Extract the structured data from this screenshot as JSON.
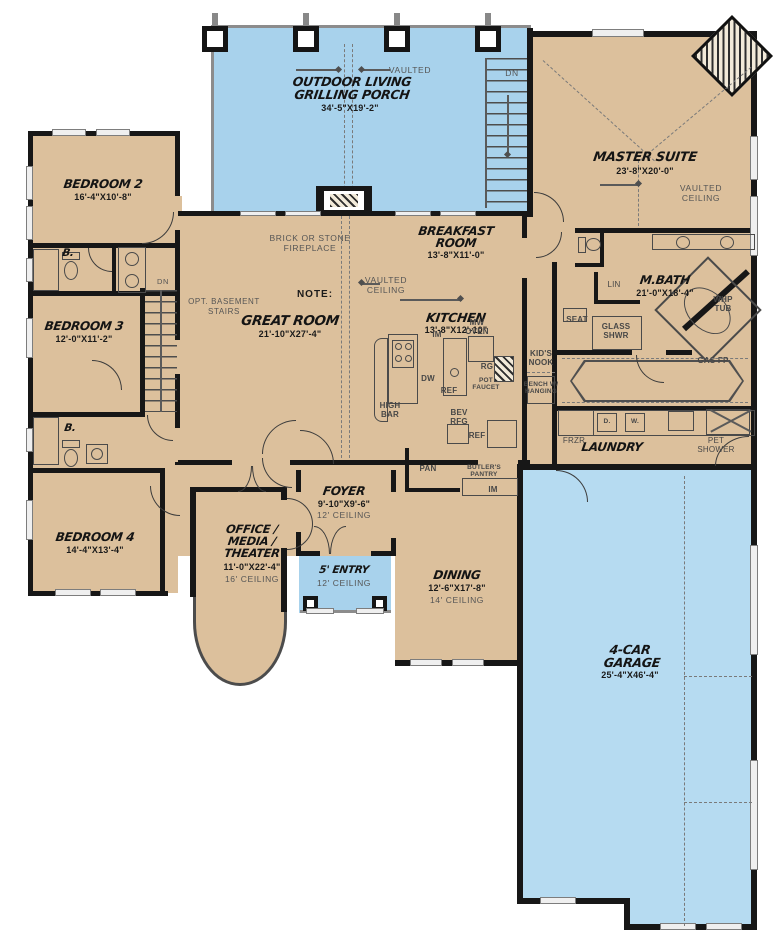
{
  "plan_type": "first-floor-plan",
  "colors": {
    "floor": "#dcc09c",
    "porch_blue": "#a8d2ec",
    "garage_blue": "#b6dbf1",
    "wall": "#171717"
  },
  "rooms": {
    "outdoor_living": {
      "name_line1": "OUTDOOR LIVING",
      "name_line2": "GRILLING PORCH",
      "dims": "34'-5\"X19'-2\""
    },
    "master_suite": {
      "name": "MASTER SUITE",
      "dims": "23'-8\"X20'-0\"",
      "ceiling": "VAULTED\nCEILING"
    },
    "bedroom_2": {
      "name": "BEDROOM 2",
      "dims": "16'-4\"X10'-8\""
    },
    "bedroom_3": {
      "name": "BEDROOM 3",
      "dims": "12'-0\"X11'-2\""
    },
    "bedroom_4": {
      "name": "BEDROOM 4",
      "dims": "14'-4\"X13'-4\""
    },
    "great_room": {
      "name": "GREAT ROOM",
      "dims": "21'-10\"X27'-4\""
    },
    "breakfast_room": {
      "name_line1": "BREAKFAST",
      "name_line2": "ROOM",
      "dims": "13'-8\"X11'-0\""
    },
    "kitchen": {
      "name": "KITCHEN",
      "dims": "13'-8\"X12'-10\""
    },
    "m_bath": {
      "name": "M.BATH",
      "dims": "21'-0\"X18'-4\""
    },
    "foyer": {
      "name": "FOYER",
      "dims": "9'-10\"X9'-6\"",
      "ceiling": "12' CEILING"
    },
    "entry": {
      "name": "5' ENTRY",
      "ceiling": "12' CEILING"
    },
    "dining": {
      "name": "DINING",
      "dims": "12'-6\"X17'-8\"",
      "ceiling": "14' CEILING"
    },
    "office": {
      "name_line1": "OFFICE /",
      "name_line2": "MEDIA /",
      "name_line3": "THEATER",
      "dims": "11'-0\"X22'-4\"",
      "ceiling": "16' CEILING"
    },
    "garage": {
      "name_line1": "4-CAR",
      "name_line2": "GARAGE",
      "dims": "25'-4\"X46'-4\""
    },
    "laundry": {
      "name": "LAUNDRY"
    },
    "kids_nook": {
      "name": "KID'S\nNOOK",
      "note": "BENCH W/\nHANGING"
    }
  },
  "labels": {
    "vaulted": "VAULTED",
    "dn_porch": "DN",
    "dn_basement": "DN",
    "fireplace": "BRICK OR STONE\nFIREPLACE",
    "note": "NOTE:",
    "opt_basement": "OPT. BASEMENT\nSTAIRS",
    "vaulted_ceiling_kitchen": "VAULTED\nCEILING",
    "vaulted_ceiling_master": "VAULTED\nCEILING",
    "mw_oven": "MW\nOVEN",
    "im1": "IM",
    "im2": "IM",
    "dw": "DW",
    "ref_island": "REF",
    "ref2": "REF",
    "high_bar": "HIGH\nBAR",
    "rg": "RG",
    "pot_faucet": "POT\nFAUCET",
    "bev_rfg": "BEV\nRFG",
    "pan": "PAN",
    "butlers_pantry": "BUTLER'S\nPANTRY",
    "lin": "LIN",
    "seat": "SEAT",
    "glass_shwr": "GLASS\nSHWR",
    "whp_tub": "WHP\nTUB",
    "gas_fp": "GAS FP",
    "frzr": "FRZR",
    "dryer": "D.",
    "washer": "W.",
    "pet_shower": "PET\nSHOWER",
    "bath_2": "B.",
    "bath_3": "B."
  }
}
